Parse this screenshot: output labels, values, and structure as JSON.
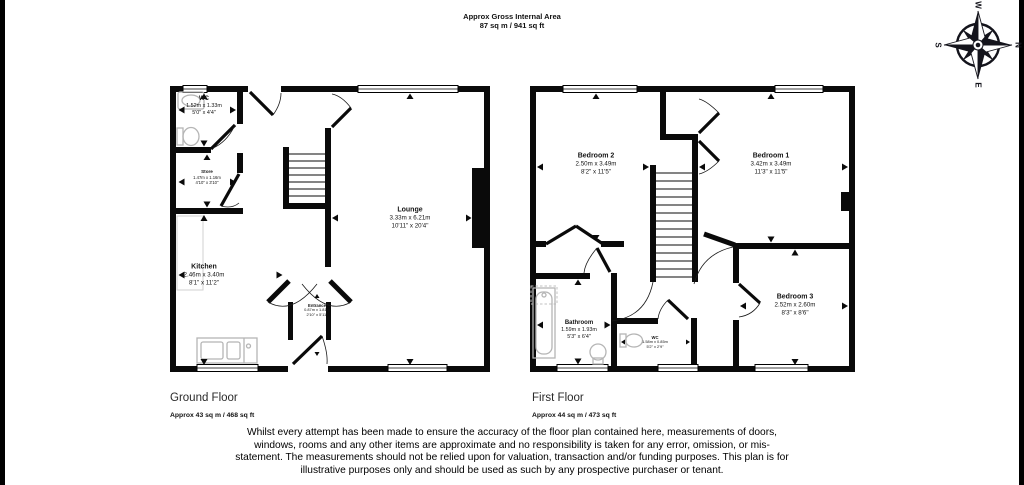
{
  "header": {
    "line1": "Approx Gross Internal Area",
    "line2": "87 sq m / 941 sq ft"
  },
  "compass": {
    "north": "N",
    "east": "E",
    "south": "S",
    "west": "W"
  },
  "floors": {
    "ground": {
      "title": "Ground Floor",
      "area": "Approx 43 sq m / 468 sq ft",
      "rooms": {
        "wc": {
          "name": "WC",
          "metric": "1.52m x 1.33m",
          "imperial": "5'0\" x 4'4\""
        },
        "store": {
          "name": "Store",
          "metric": "1.47m x 1.16m",
          "imperial": "4'10\" x 3'10\""
        },
        "kitchen": {
          "name": "Kitchen",
          "metric": "2.46m x 3.40m",
          "imperial": "8'1\" x 11'2\""
        },
        "lounge": {
          "name": "Lounge",
          "metric": "3.33m x 6.21m",
          "imperial": "10'11\" x 20'4\""
        },
        "entrance": {
          "name": "Entrance",
          "metric": "0.87m x 1.81m",
          "imperial": "2'10\" x 5'11\""
        }
      }
    },
    "first": {
      "title": "First Floor",
      "area": "Approx 44 sq m / 473 sq ft",
      "rooms": {
        "bedroom2": {
          "name": "Bedroom 2",
          "metric": "2.50m x 3.49m",
          "imperial": "8'2\" x 11'5\""
        },
        "bedroom1": {
          "name": "Bedroom 1",
          "metric": "3.42m x 3.49m",
          "imperial": "11'3\" x 11'5\""
        },
        "bedroom3": {
          "name": "Bedroom 3",
          "metric": "2.52m x 2.60m",
          "imperial": "8'3\" x 8'6\""
        },
        "bathroom": {
          "name": "Bathroom",
          "metric": "1.59m x 1.93m",
          "imperial": "5'3\" x 6'4\""
        },
        "wc": {
          "name": "WC",
          "metric": "1.58m x 0.85m",
          "imperial": "5'2\" x 2'9\""
        }
      }
    }
  },
  "disclaimer": "Whilst every attempt has been made to ensure the accuracy of the floor plan contained here, measurements of doors, windows, rooms and any other items are approximate and no responsibility is taken for any error, omission, or mis-statement. The measurements should not be relied upon for valuation, transaction and/or funding purposes. This plan is for illustrative purposes only and should be used as such by any prospective purchaser or tenant.",
  "colors": {
    "wall": "#0a0a0a",
    "fixture": "#b5b5b5",
    "text": "#111111"
  }
}
